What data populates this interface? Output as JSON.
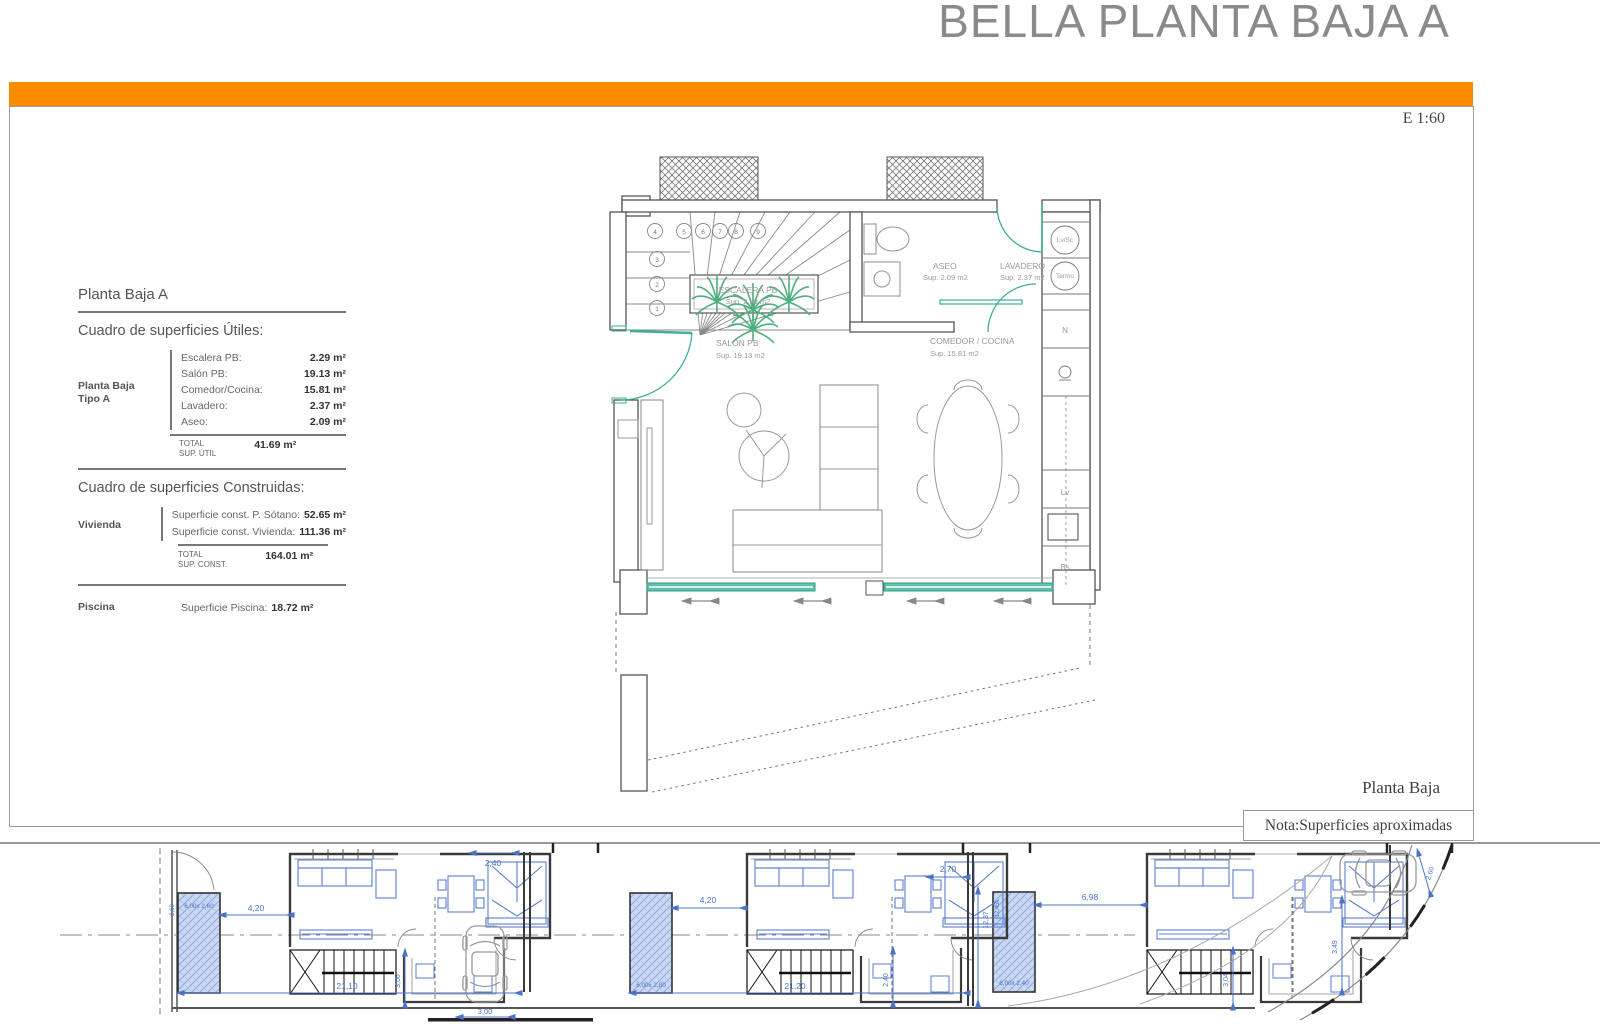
{
  "header": {
    "title": "BELLA PLANTA BAJA A",
    "scale": "E 1:60"
  },
  "footer": {
    "plan_name": "Planta Baja",
    "note": "Nota:Superficies aproximadas"
  },
  "colors": {
    "accent_orange": "#FB8C00",
    "teal": "#3FAE96",
    "plant_green": "#4EAE7E",
    "site_blue": "#4A73C9",
    "pool_fill": "#CCD9F2",
    "title_gray": "#8A8A8A"
  },
  "panel": {
    "section_title": "Planta Baja A",
    "utiles": {
      "title": "Cuadro de superficies Útiles:",
      "group_line1": "Planta Baja",
      "group_line2": "Tipo A",
      "rows": [
        {
          "label": "Escalera PB:",
          "value": "2.29 m²"
        },
        {
          "label": "Salón PB:",
          "value": "19.13 m²"
        },
        {
          "label": "Comedor/Cocina:",
          "value": "15.81 m²"
        },
        {
          "label": "Lavadero:",
          "value": "2.37 m²"
        },
        {
          "label": "Aseo:",
          "value": "2.09 m²"
        }
      ],
      "total_label1": "TOTAL",
      "total_label2": "SUP. ÚTIL",
      "total_value": "41.69 m²"
    },
    "construidas": {
      "title": "Cuadro de superficies Construidas:",
      "group": "Vivienda",
      "rows": [
        {
          "label": "Superficie const. P. Sótano:",
          "value": "52.65 m²"
        },
        {
          "label": "Superficie const. Vivienda:",
          "value": "111.36 m²"
        }
      ],
      "total_label1": "TOTAL",
      "total_label2": "SUP. CONST.",
      "total_value": "164.01 m²"
    },
    "piscina": {
      "group": "Piscina",
      "label": "Superficie Piscina:",
      "value": "18.72 m²"
    }
  },
  "plan": {
    "escalera": {
      "name": "ESCALERA PB",
      "sup": "Sup. 2.29 m2"
    },
    "salon": {
      "name": "SALÓN PB",
      "sup": "Sup. 19.13 m2"
    },
    "comedor": {
      "name": "COMEDOR / COCINA",
      "sup": "Sup. 15.81 m2"
    },
    "aseo": {
      "name": "ASEO",
      "sup": "Sup. 2.09 m2"
    },
    "lavadero": {
      "name": "LAVADERO",
      "sup": "Sup. 2.37 m2"
    },
    "appliances": {
      "lvsc": "Lv/Sc",
      "termo": "Termo",
      "nevera": "N",
      "lavavajillas": "Lv",
      "basura": "Bs"
    },
    "stairs": [
      "1",
      "2",
      "3",
      "4",
      "5",
      "6",
      "7",
      "8",
      "9"
    ]
  },
  "site": {
    "u1": {
      "gap": "4,20",
      "width": "21,10",
      "v": "3,06",
      "top": "2,40",
      "small": "3,00",
      "pool": "6,00x 2,60",
      "pool_v": "2,60"
    },
    "u2": {
      "gap": "4,20",
      "width": "21,20",
      "right_top": "2,70",
      "right_v": "12,37",
      "v": "2,40",
      "pool": "6,00x 2,80"
    },
    "u3": {
      "gap": "6,98",
      "v": "3,04",
      "right_v": "3,49",
      "curve": "2,60",
      "pool": "6,00x 2,40",
      "pool_v": "12,45"
    }
  }
}
